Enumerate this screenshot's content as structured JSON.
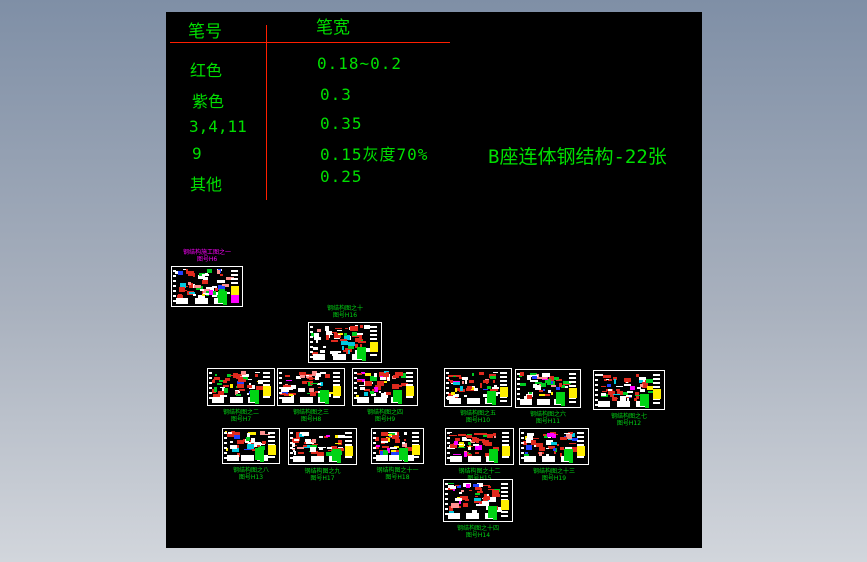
{
  "colors": {
    "canvas_bg": "#000000",
    "bg_top": "#7f8fa6",
    "bg_bottom": "#d2d6dc",
    "text_green": "#00df00",
    "line_red": "#ff1f00",
    "label_green": "#00d414",
    "label_magenta": "#ff00ff"
  },
  "pen_table": {
    "col1_header": "笔号",
    "col2_header": "笔宽",
    "rows": [
      {
        "label": "红色",
        "value": "0.18~0.2"
      },
      {
        "label": "紫色",
        "value": "0.3"
      },
      {
        "label": "3,4,11",
        "value": "0.35"
      },
      {
        "label": "9",
        "value": "0.15灰度70%"
      },
      {
        "label": "其他",
        "value": "0.25"
      }
    ]
  },
  "title": {
    "text": "B座连体钢结构-22张"
  },
  "sheets": [
    {
      "x": 5,
      "y": 254,
      "w": 72,
      "h": 41,
      "label_position": "above",
      "label_color": "#ff00ff",
      "line1": "钢结构施工图之一",
      "line2": "图号H6"
    },
    {
      "x": 142,
      "y": 310,
      "w": 74,
      "h": 41,
      "label_position": "above",
      "label_color": "#00d414",
      "line1": "钢结构图之十",
      "line2": "图号H16"
    },
    {
      "x": 41,
      "y": 356,
      "w": 68,
      "h": 38,
      "label_position": "below",
      "label_color": "#00d414",
      "line1": "钢结构图之二",
      "line2": "图号H7"
    },
    {
      "x": 111,
      "y": 356,
      "w": 68,
      "h": 38,
      "label_position": "below",
      "label_color": "#00d414",
      "line1": "钢结构图之三",
      "line2": "图号H8"
    },
    {
      "x": 186,
      "y": 356,
      "w": 66,
      "h": 38,
      "label_position": "below",
      "label_color": "#00d414",
      "line1": "钢结构图之四",
      "line2": "图号H9"
    },
    {
      "x": 278,
      "y": 356,
      "w": 68,
      "h": 39,
      "label_position": "below",
      "label_color": "#00d414",
      "line1": "钢结构图之五",
      "line2": "图号H10"
    },
    {
      "x": 349,
      "y": 357,
      "w": 66,
      "h": 39,
      "label_position": "below",
      "label_color": "#00d414",
      "line1": "钢结构图之六",
      "line2": "图号H11"
    },
    {
      "x": 427,
      "y": 358,
      "w": 72,
      "h": 40,
      "label_position": "below",
      "label_color": "#00d414",
      "line1": "钢结构图之七",
      "line2": "图号H12"
    },
    {
      "x": 56,
      "y": 416,
      "w": 58,
      "h": 36,
      "label_position": "below",
      "label_color": "#00d414",
      "line1": "钢结构图之八",
      "line2": "图号H13"
    },
    {
      "x": 122,
      "y": 416,
      "w": 69,
      "h": 37,
      "label_position": "below",
      "label_color": "#00d414",
      "line1": "钢结构图之九",
      "line2": "图号H17"
    },
    {
      "x": 205,
      "y": 416,
      "w": 53,
      "h": 36,
      "label_position": "below",
      "label_color": "#00d414",
      "line1": "钢结构图之十一",
      "line2": "图号H18"
    },
    {
      "x": 279,
      "y": 416,
      "w": 69,
      "h": 37,
      "label_position": "below",
      "label_color": "#00d414",
      "line1": "钢结构图之十二",
      "line2": "图号H15"
    },
    {
      "x": 353,
      "y": 416,
      "w": 70,
      "h": 37,
      "label_position": "below",
      "label_color": "#00d414",
      "line1": "钢结构图之十三",
      "line2": "图号H19"
    },
    {
      "x": 277,
      "y": 467,
      "w": 70,
      "h": 43,
      "label_position": "below",
      "label_color": "#00d414",
      "line1": "钢结构图之十四",
      "line2": "图号H14"
    }
  ]
}
